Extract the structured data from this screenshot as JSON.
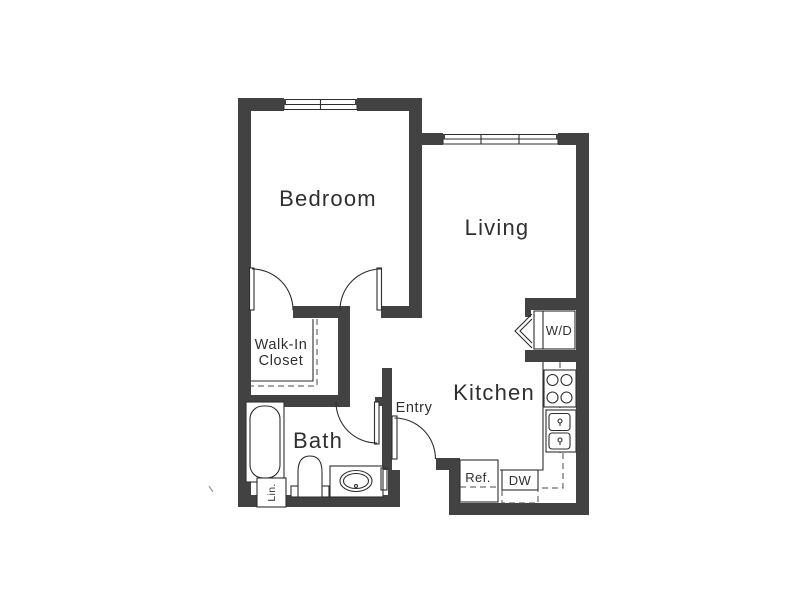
{
  "colors": {
    "wall": "#424242",
    "line": "#2e2e2e",
    "dash": "#4a4a4a",
    "text": "#2f2f2f",
    "bg": "#ffffff"
  },
  "rooms": {
    "bedroom": "Bedroom",
    "living": "Living",
    "kitchen": "Kitchen",
    "bath": "Bath",
    "entry": "Entry",
    "walk_in_closet_line1": "Walk-In",
    "walk_in_closet_line2": "Closet"
  },
  "fixtures": {
    "washer_dryer": "W/D",
    "refrigerator": "Ref.",
    "dishwasher": "DW",
    "linen": "Lin."
  }
}
